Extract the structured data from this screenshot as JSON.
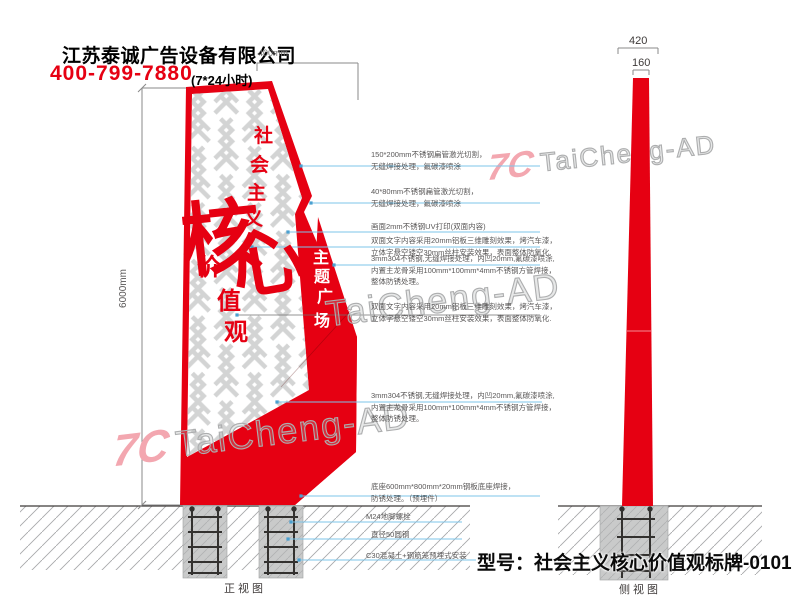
{
  "header": {
    "company": "江苏泰诚广告设备有限公司",
    "phone": "400-799-7880",
    "hours_note": "(7*24小时)"
  },
  "dimensions": {
    "front_top_width": "400mm",
    "front_height": "6000mm",
    "side_bottom_width": "420",
    "side_top_width": "160"
  },
  "sign_text": {
    "slogan_col1": [
      "社",
      "会",
      "主",
      "义"
    ],
    "slogan_big": [
      "核",
      "心"
    ],
    "slogan_col2": [
      "价",
      "值",
      "观"
    ],
    "plaza_col": [
      "主",
      "题",
      "广",
      "场"
    ]
  },
  "annotations": [
    {
      "text": "150*200mm不锈钢扁管激光切割，\n无缝焊接处理，氟碳漆喷涂"
    },
    {
      "text": "40*80mm不锈钢扁管激光切割，\n无缝焊接处理，氟碳漆喷涂"
    },
    {
      "text": "画面2mm不锈钢UV打印(双面内容)"
    },
    {
      "text": "双面文字内容采用20mm铝板三维雕刻效果，烤汽车漆，\n立体字悬空镂空30mm丝柱安装效果，表面整体防氧化."
    },
    {
      "text": "3mm304不锈钢,无缝焊接处理，内凹20mm,氟碳漆喷涂,\n内置主龙骨采用100mm*100mm*4mm不锈钢方管焊接，\n整体防锈处理。"
    },
    {
      "text": "双面文字内容采用20mm铝板三维雕刻效果，烤汽车漆，\n立体字悬空镂空30mm丝柱安装效果，表面整体防氧化."
    },
    {
      "text": "3mm304不锈钢,无缝焊接处理，内凹20mm,氟碳漆喷涂,\n内置主龙骨采用100mm*100mm*4mm不锈钢方管焊接，\n整体防锈处理。"
    },
    {
      "text": "底座600mm*800mm*20mm钢板底座焊接，\n防锈处理。（预埋件）"
    },
    {
      "text": "M24地脚螺栓"
    },
    {
      "text": "直径50圆钢"
    },
    {
      "text": "C30混凝土+钢筋笼预埋式安装"
    }
  ],
  "views": {
    "front_label": "正视图",
    "side_label": "侧视图"
  },
  "footer": {
    "model": "型号：社会主义核心价值观标牌-0101"
  },
  "watermark": {
    "logo": "7C",
    "text": "TaiCheng-AD"
  },
  "colors": {
    "brand_red": "#e60012",
    "leader_blue": "#7dc5ea",
    "watermark_pink": "#f3a7b0",
    "annotation_gray": "#595757"
  }
}
